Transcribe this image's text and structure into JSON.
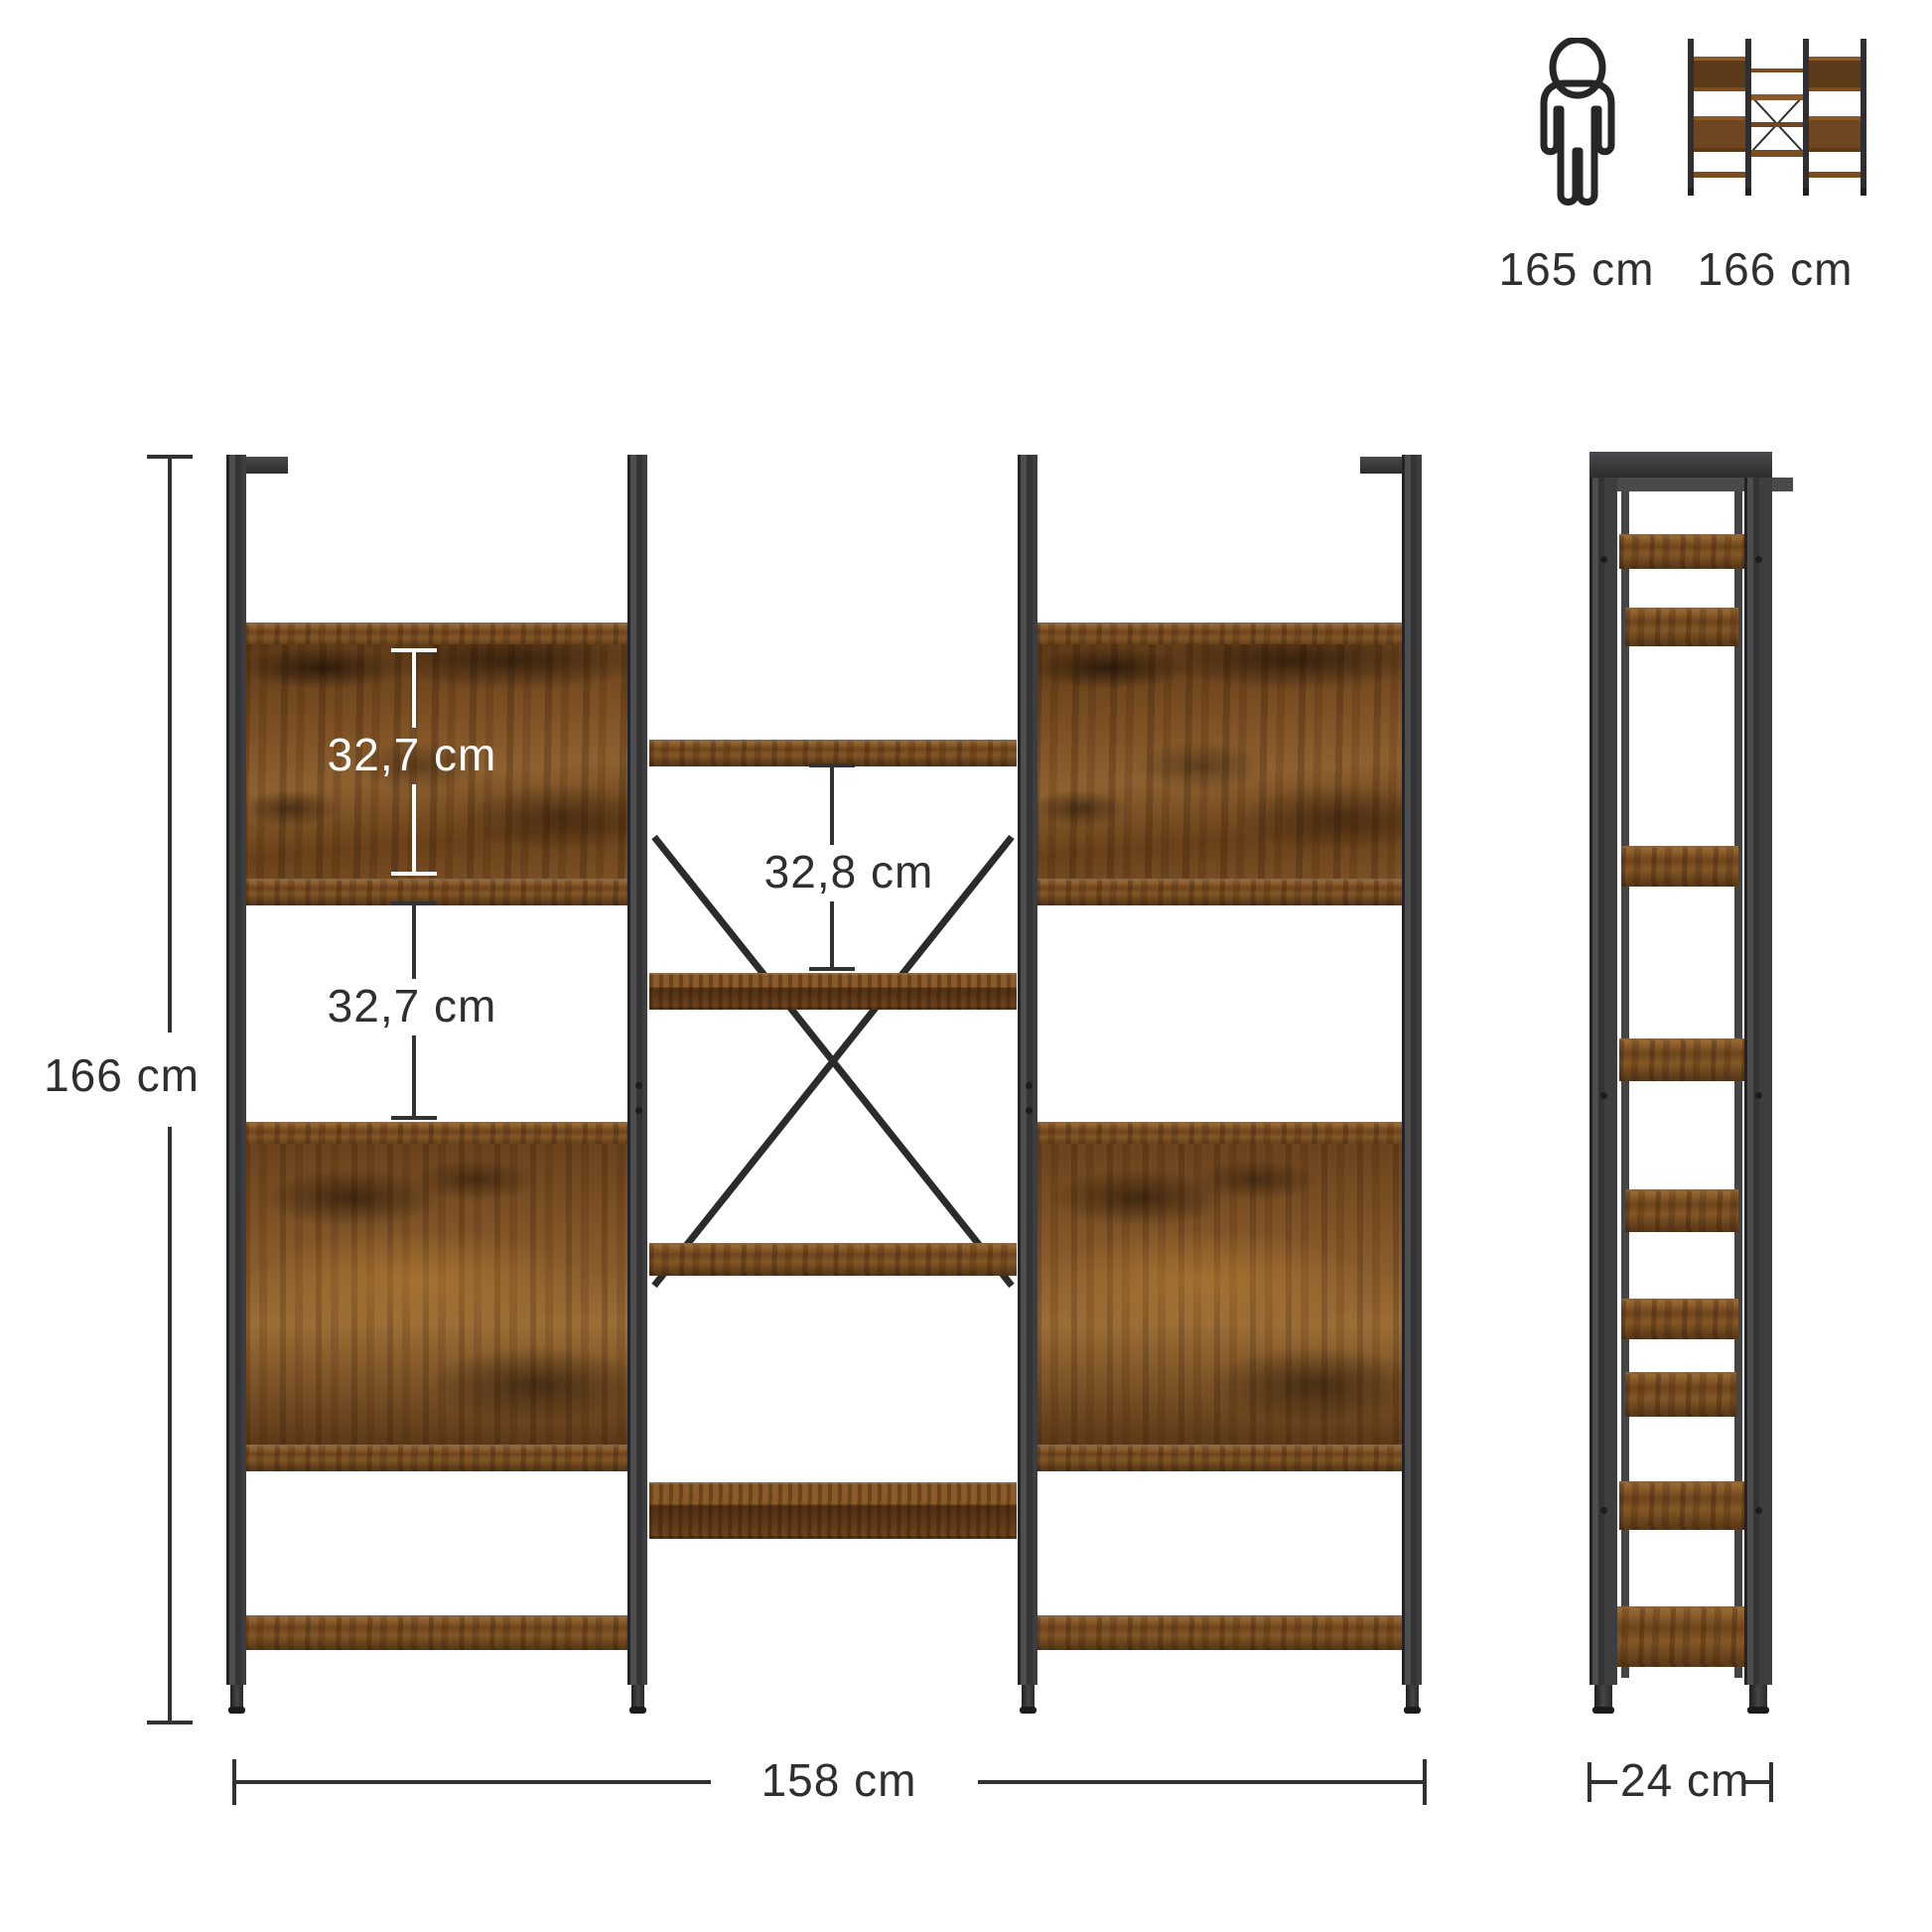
{
  "scale_reference": {
    "person_height_label": "165 cm",
    "product_height_label": "166 cm"
  },
  "front_view": {
    "overall_height_label": "166 cm",
    "overall_width_label": "158 cm",
    "upper_gap_label": "32,7 cm",
    "lower_gap_label": "32,7 cm",
    "center_gap_label": "32,8 cm"
  },
  "side_view": {
    "depth_label": "24 cm"
  },
  "colors": {
    "background": "#ffffff",
    "metal": "#3a3a3c",
    "wood": "#7b4e22",
    "dimension_line": "#323232",
    "white_dimension": "#ffffff"
  }
}
